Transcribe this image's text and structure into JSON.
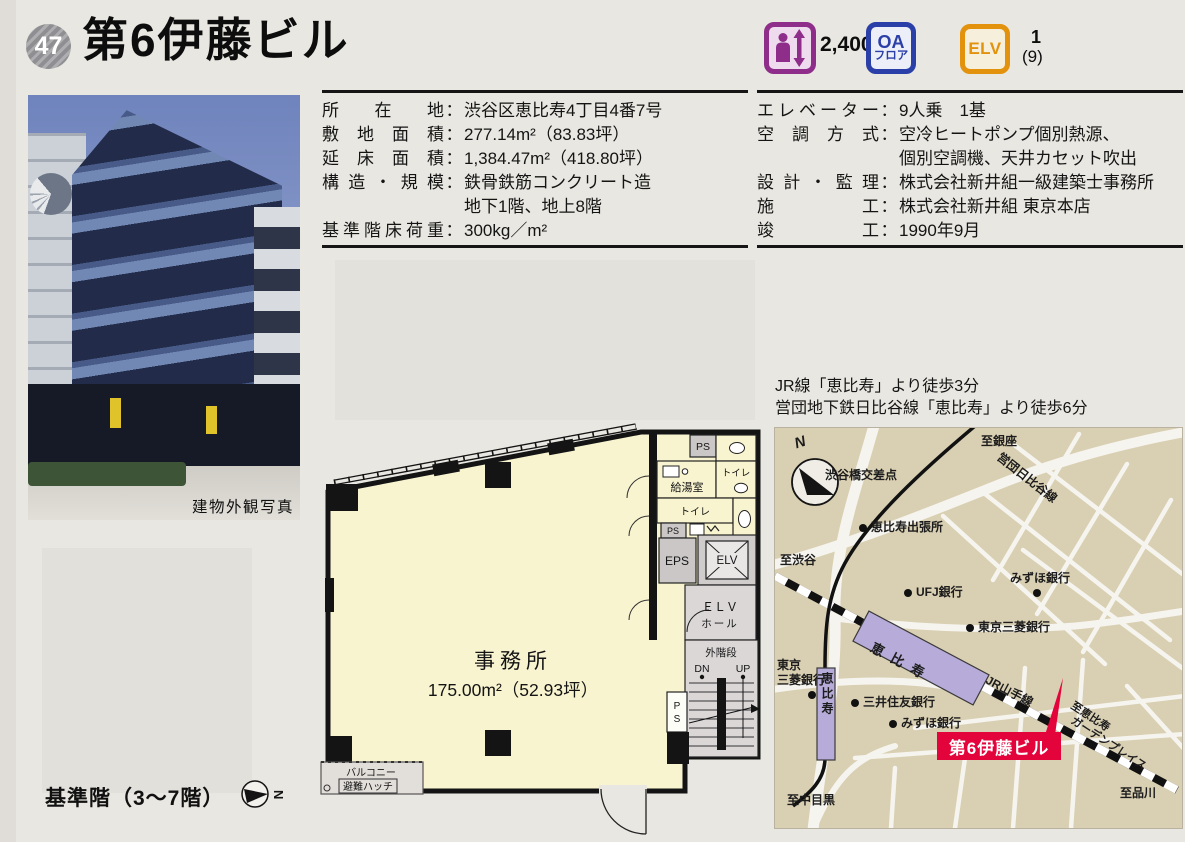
{
  "header": {
    "number": "47",
    "title": "第6伊藤ビル"
  },
  "punct": {
    "colon": "："
  },
  "badges": {
    "capacity": "2,400",
    "oa": {
      "line1": "OA",
      "line2": "フロア"
    },
    "elv": {
      "label": "ELV",
      "count": "1",
      "capacity": "(9)"
    }
  },
  "photo": {
    "caption": "建物外観写真"
  },
  "specs_left": {
    "rows": [
      {
        "label": "所在地",
        "value": "渋谷区恵比寿4丁目4番7号"
      },
      {
        "label": "敷地面積",
        "value": "277.14m²（83.83坪）"
      },
      {
        "label": "延床面積",
        "value": "1,384.47m²（418.80坪）"
      },
      {
        "label": "構造・規模",
        "value": "鉄骨鉄筋コンクリート造",
        "value2": "地下1階、地上8階"
      },
      {
        "label": "基準階床荷重",
        "value": "300kg／m²"
      }
    ]
  },
  "specs_right": {
    "rows": [
      {
        "label": "エレベーター",
        "value": "9人乗　1基"
      },
      {
        "label": "空調方式",
        "value": "空冷ヒートポンプ個別熱源、",
        "value2": "個別空調機、天井カセット吹出"
      },
      {
        "label": "設計・監理",
        "value": "株式会社新井組一級建築士事務所"
      },
      {
        "label": "施工",
        "value": "株式会社新井組 東京本店"
      },
      {
        "label": "竣工",
        "value": "1990年9月"
      }
    ]
  },
  "floorplan": {
    "office": "事務所",
    "area": "175.00m²（52.93坪）",
    "ps_top": "PS",
    "kitchen": "給湯室",
    "toilet_right": "トイレ",
    "toilet_left": "トイレ",
    "ps_small": "PS",
    "eps": "EPS",
    "elv": "ELV",
    "elv_hall_line1": "ＥＬＶ",
    "elv_hall_line2": "ホール",
    "stairs": "外階段",
    "down": "DN",
    "up": "UP",
    "ps_stairs_1": "P",
    "ps_stairs_2": "S",
    "balcony": "バルコニー",
    "hatch": "避難ハッチ",
    "note": "基準階（3～7階）",
    "compass": "N"
  },
  "access": {
    "line1": "JR線「恵比寿」より徒歩3分",
    "line2": "営団地下鉄日比谷線「恵比寿」より徒歩6分"
  },
  "map": {
    "compass": "N",
    "to_ginza": "至銀座",
    "hibiya_line": "営団日比谷線",
    "shibuyabashi": "渋谷橋交差点",
    "ebisu_branch": "恵比寿出張所",
    "to_shibuya": "至渋谷",
    "ufj": "UFJ銀行",
    "mizuho_upper": "みずほ銀行",
    "mitsubishi_upper": "東京三菱銀行",
    "jr_station": "恵比寿",
    "yamanote": "JR山手線",
    "mitsubishi_left_1": "東京",
    "mitsubishi_left_2": "三菱銀行",
    "hibiya_station": "恵比寿",
    "smbc": "三井住友銀行",
    "mizuho_lower": "みずほ銀行",
    "building": "第6伊藤ビル",
    "to_garden_1": "至恵比寿",
    "to_garden_2": "ガーデンプレイス",
    "to_shinagawa": "至品川",
    "to_nakameguro": "至中目黒"
  }
}
